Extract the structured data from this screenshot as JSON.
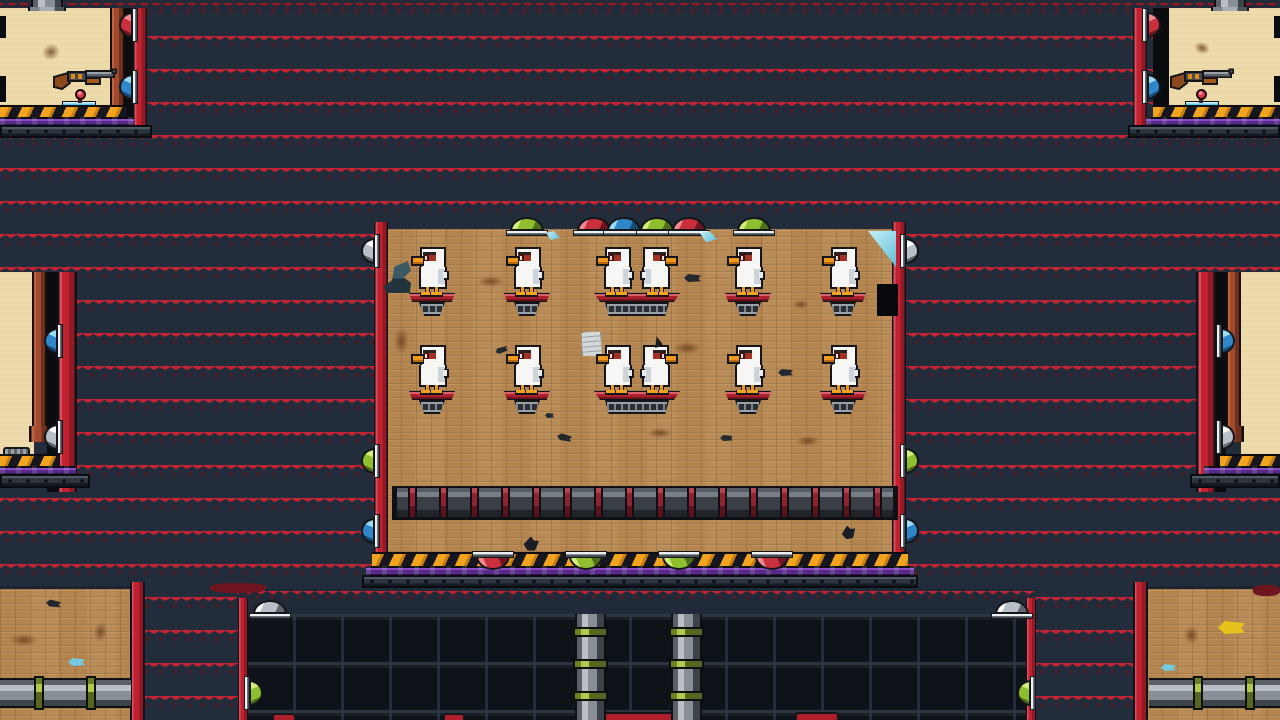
{
  "scene": {
    "description": "pixel-art duck shooting-gallery level",
    "visible_text": [],
    "palette": {
      "wall_red": "#c22433",
      "wall_stripe_dark": "#8e1824",
      "wall_trim_navy": "#222c3a",
      "wood": "#b5854f",
      "beige_room": "#eedbab",
      "hazard_orange": "#f2a41f",
      "goo_purple": "#562a86",
      "grate_dark": "#0e1219",
      "dome_green": "#8fbf2e",
      "dome_red": "#c92f3d",
      "dome_blue": "#2f86c9",
      "dome_silver": "#b9bfc6",
      "duck_white": "#f6f6f4",
      "duck_beak_orange": "#f0991c",
      "perch_red": "#ac1f2c"
    },
    "counts": {
      "ducks": 12,
      "perches": 10,
      "shotguns": 2,
      "spawn_pins": 2
    },
    "regions": [
      {
        "t": "redband",
        "x": 0,
        "y": 0,
        "w": 1280,
        "h": 10
      },
      {
        "t": "beige",
        "x": 0,
        "y": 8,
        "w": 112,
        "h": 99
      },
      {
        "t": "pillar",
        "x": 110,
        "y": 8,
        "w": 15,
        "h": 101
      },
      {
        "t": "gap",
        "x": 125,
        "y": 8,
        "w": 9,
        "h": 122
      },
      {
        "t": "beam",
        "x": 133,
        "y": 8,
        "w": 14,
        "h": 124
      },
      {
        "t": "hazard",
        "x": 0,
        "y": 105,
        "w": 127,
        "h": 14
      },
      {
        "t": "purple",
        "x": 0,
        "y": 117,
        "w": 134,
        "h": 10
      },
      {
        "t": "basebar",
        "x": 0,
        "y": 125,
        "w": 152,
        "h": 13
      },
      {
        "t": "beige",
        "x": 1168,
        "y": 8,
        "w": 112,
        "h": 99
      },
      {
        "t": "gap",
        "x": 1153,
        "y": 8,
        "w": 16,
        "h": 122
      },
      {
        "t": "beam",
        "x": 1133,
        "y": 8,
        "w": 14,
        "h": 124
      },
      {
        "t": "hazard",
        "x": 1153,
        "y": 105,
        "w": 127,
        "h": 14
      },
      {
        "t": "purple",
        "x": 1146,
        "y": 117,
        "w": 134,
        "h": 10
      },
      {
        "t": "basebar",
        "x": 1128,
        "y": 125,
        "w": 152,
        "h": 13
      },
      {
        "t": "beige",
        "x": 0,
        "y": 272,
        "w": 34,
        "h": 184
      },
      {
        "t": "pillar",
        "x": 32,
        "y": 272,
        "w": 15,
        "h": 170,
        "cap": true
      },
      {
        "t": "gap",
        "x": 47,
        "y": 272,
        "w": 10,
        "h": 220
      },
      {
        "t": "beam",
        "x": 57,
        "y": 272,
        "w": 20,
        "h": 220
      },
      {
        "t": "hazard",
        "x": 0,
        "y": 454,
        "w": 60,
        "h": 14
      },
      {
        "t": "purple",
        "x": 0,
        "y": 466,
        "w": 76,
        "h": 10
      },
      {
        "t": "basebar",
        "x": 0,
        "y": 474,
        "w": 90,
        "h": 14
      },
      {
        "t": "beige",
        "x": 1241,
        "y": 272,
        "w": 39,
        "h": 184
      },
      {
        "t": "pillar",
        "x": 1226,
        "y": 272,
        "w": 15,
        "h": 170,
        "cap": true
      },
      {
        "t": "gap",
        "x": 1216,
        "y": 272,
        "w": 10,
        "h": 220
      },
      {
        "t": "beam",
        "x": 1196,
        "y": 272,
        "w": 20,
        "h": 220
      },
      {
        "t": "hazard",
        "x": 1220,
        "y": 454,
        "w": 60,
        "h": 14
      },
      {
        "t": "purple",
        "x": 1204,
        "y": 466,
        "w": 76,
        "h": 10
      },
      {
        "t": "basebar",
        "x": 1190,
        "y": 474,
        "w": 90,
        "h": 14
      },
      {
        "t": "wood",
        "x": 386,
        "y": 229,
        "w": 508,
        "h": 325
      },
      {
        "t": "beam",
        "x": 374,
        "y": 222,
        "w": 14,
        "h": 362
      },
      {
        "t": "beam",
        "x": 892,
        "y": 222,
        "w": 14,
        "h": 362
      },
      {
        "t": "hazard",
        "x": 372,
        "y": 552,
        "w": 536,
        "h": 16
      },
      {
        "t": "purple",
        "x": 366,
        "y": 566,
        "w": 548,
        "h": 11
      },
      {
        "t": "basebar",
        "x": 362,
        "y": 575,
        "w": 556,
        "h": 13
      },
      {
        "t": "wood",
        "x": 0,
        "y": 586,
        "w": 131,
        "h": 134,
        "topline": true
      },
      {
        "t": "wood",
        "x": 1147,
        "y": 586,
        "w": 133,
        "h": 134,
        "topline": true
      },
      {
        "t": "redband",
        "x": 237,
        "y": 588,
        "w": 798,
        "h": 27
      },
      {
        "t": "grid",
        "x": 245,
        "y": 614,
        "w": 781,
        "h": 106
      },
      {
        "t": "beam",
        "x": 238,
        "y": 598,
        "w": 10,
        "h": 122
      },
      {
        "t": "beam",
        "x": 1026,
        "y": 598,
        "w": 10,
        "h": 122
      },
      {
        "t": "beam",
        "x": 130,
        "y": 582,
        "w": 15,
        "h": 138
      },
      {
        "t": "beam",
        "x": 1133,
        "y": 582,
        "w": 15,
        "h": 138
      },
      {
        "t": "tongue",
        "x": 272,
        "y": 713,
        "w": 24,
        "h": 7
      },
      {
        "t": "tongue",
        "x": 443,
        "y": 713,
        "w": 22,
        "h": 7
      },
      {
        "t": "tongue",
        "x": 600,
        "y": 712,
        "w": 78,
        "h": 8
      },
      {
        "t": "tongue",
        "x": 795,
        "y": 712,
        "w": 44,
        "h": 8
      },
      {
        "t": "strip",
        "x": 0,
        "y": 16,
        "w": 6,
        "h": 22
      },
      {
        "t": "strip",
        "x": 0,
        "y": 76,
        "w": 6,
        "h": 26
      },
      {
        "t": "strip",
        "x": 1274,
        "y": 16,
        "w": 6,
        "h": 22
      },
      {
        "t": "strip",
        "x": 1274,
        "y": 76,
        "w": 6,
        "h": 26
      }
    ],
    "pipes": [
      {
        "t": "stub",
        "x": 31,
        "y": 0,
        "w": 32,
        "h": 9,
        "flange": true
      },
      {
        "t": "stub",
        "x": 1214,
        "y": 0,
        "w": 32,
        "h": 9,
        "flange": true
      },
      {
        "t": "bigpipe",
        "x": 392,
        "y": 486,
        "w": 506,
        "h": 34,
        "cstart": 16,
        "cstep": 31
      },
      {
        "t": "vpipe",
        "x": 575,
        "y": 614,
        "w": 31,
        "h": 106,
        "bands": [
          13,
          45,
          77
        ]
      },
      {
        "t": "vpipe",
        "x": 671,
        "y": 614,
        "w": 31,
        "h": 106,
        "bands": [
          13,
          45,
          77
        ]
      },
      {
        "t": "hpipe",
        "x": 0,
        "y": 678,
        "w": 131,
        "h": 30,
        "bands": [
          34,
          86
        ]
      },
      {
        "t": "hpipe",
        "x": 1149,
        "y": 678,
        "w": 131,
        "h": 30,
        "bands": [
          44,
          96
        ]
      }
    ],
    "dome_lights": [
      {
        "dir": "up",
        "color": "green",
        "x": 510,
        "y": 217
      },
      {
        "dir": "up",
        "color": "red",
        "x": 577,
        "y": 217
      },
      {
        "dir": "up",
        "color": "blue",
        "x": 607,
        "y": 217
      },
      {
        "dir": "up",
        "color": "green",
        "x": 640,
        "y": 217
      },
      {
        "dir": "up",
        "color": "red",
        "x": 672,
        "y": 217
      },
      {
        "dir": "up",
        "color": "green",
        "x": 737,
        "y": 217
      },
      {
        "dir": "down",
        "color": "red",
        "x": 476,
        "y": 556
      },
      {
        "dir": "down",
        "color": "green",
        "x": 569,
        "y": 556
      },
      {
        "dir": "down",
        "color": "green",
        "x": 662,
        "y": 556
      },
      {
        "dir": "down",
        "color": "red",
        "x": 755,
        "y": 556
      },
      {
        "dir": "left",
        "color": "red",
        "x": 119,
        "y": 12
      },
      {
        "dir": "left",
        "color": "blue",
        "x": 119,
        "y": 74
      },
      {
        "dir": "right",
        "color": "red",
        "x": 1147,
        "y": 12
      },
      {
        "dir": "right",
        "color": "blue",
        "x": 1147,
        "y": 74
      },
      {
        "dir": "left",
        "color": "blue",
        "x": 44,
        "y": 328
      },
      {
        "dir": "left",
        "color": "silver",
        "x": 44,
        "y": 424
      },
      {
        "dir": "right",
        "color": "blue",
        "x": 1221,
        "y": 328
      },
      {
        "dir": "right",
        "color": "silver",
        "x": 1221,
        "y": 424
      },
      {
        "dir": "left",
        "color": "silver",
        "x": 361,
        "y": 238
      },
      {
        "dir": "left",
        "color": "green",
        "x": 361,
        "y": 448
      },
      {
        "dir": "left",
        "color": "blue",
        "x": 361,
        "y": 518
      },
      {
        "dir": "right",
        "color": "silver",
        "x": 905,
        "y": 238
      },
      {
        "dir": "right",
        "color": "green",
        "x": 905,
        "y": 448
      },
      {
        "dir": "right",
        "color": "blue",
        "x": 905,
        "y": 518
      },
      {
        "dir": "up",
        "color": "silver",
        "x": 253,
        "y": 600
      },
      {
        "dir": "up",
        "color": "silver",
        "x": 995,
        "y": 600
      },
      {
        "dir": "right",
        "color": "green",
        "x": 249,
        "y": 680
      },
      {
        "dir": "left",
        "color": "green",
        "x": 1017,
        "y": 680
      }
    ],
    "perches": [
      {
        "cx": 432,
        "y": 293,
        "double": false
      },
      {
        "cx": 527,
        "y": 293,
        "double": false
      },
      {
        "cx": 637,
        "y": 293,
        "double": true
      },
      {
        "cx": 748,
        "y": 293,
        "double": false
      },
      {
        "cx": 843,
        "y": 293,
        "double": false
      },
      {
        "cx": 432,
        "y": 391,
        "double": false
      },
      {
        "cx": 527,
        "y": 391,
        "double": false
      },
      {
        "cx": 637,
        "y": 391,
        "double": true,
        "plume": true
      },
      {
        "cx": 748,
        "y": 391,
        "double": false
      },
      {
        "cx": 843,
        "y": 391,
        "double": false
      }
    ],
    "guns": [
      {
        "x": 53,
        "y": 66
      },
      {
        "x": 1170,
        "y": 66
      }
    ],
    "pins": [
      {
        "x": 75,
        "y": 89
      },
      {
        "x": 1196,
        "y": 89
      }
    ],
    "platforms": [
      {
        "x": 62,
        "y": 101,
        "w": 34
      },
      {
        "x": 1185,
        "y": 101,
        "w": 34
      }
    ],
    "debris": [
      {
        "k": "stain",
        "x": 42,
        "y": 44,
        "w": 18,
        "h": 16,
        "r": -30
      },
      {
        "k": "stain",
        "x": 1194,
        "y": 42,
        "w": 16,
        "h": 12,
        "r": 20
      },
      {
        "k": "stain",
        "x": 394,
        "y": 328,
        "w": 15,
        "h": 26,
        "r": 0
      },
      {
        "k": "stain",
        "x": 478,
        "y": 276,
        "w": 26,
        "h": 11,
        "r": 0
      },
      {
        "k": "stain",
        "x": 673,
        "y": 342,
        "w": 28,
        "h": 12,
        "r": 0
      },
      {
        "k": "stain",
        "x": 793,
        "y": 300,
        "w": 16,
        "h": 9,
        "r": 0
      },
      {
        "k": "stain",
        "x": 648,
        "y": 428,
        "w": 24,
        "h": 10,
        "r": 0
      },
      {
        "k": "stain",
        "x": 796,
        "y": 436,
        "w": 24,
        "h": 10,
        "r": 0
      },
      {
        "k": "stain",
        "x": 10,
        "y": 634,
        "w": 28,
        "h": 12,
        "r": 0
      },
      {
        "k": "stain",
        "x": 94,
        "y": 622,
        "w": 13,
        "h": 20,
        "r": 10
      },
      {
        "k": "stain",
        "x": 1184,
        "y": 626,
        "w": 15,
        "h": 18,
        "r": -10
      },
      {
        "k": "feather",
        "x": 684,
        "y": 274,
        "w": 17,
        "h": 8,
        "c": "#23282f",
        "r": 0
      },
      {
        "k": "feather",
        "x": 495,
        "y": 347,
        "w": 13,
        "h": 6,
        "c": "#23282f",
        "r": -20
      },
      {
        "k": "feather",
        "x": 545,
        "y": 413,
        "w": 9,
        "h": 5,
        "c": "#23282f",
        "r": 0
      },
      {
        "k": "feather",
        "x": 557,
        "y": 434,
        "w": 15,
        "h": 7,
        "c": "#23282f",
        "r": 12
      },
      {
        "k": "feather",
        "x": 720,
        "y": 435,
        "w": 13,
        "h": 6,
        "c": "#23282f",
        "r": 0
      },
      {
        "k": "feather",
        "x": 778,
        "y": 369,
        "w": 15,
        "h": 7,
        "c": "#23282f",
        "r": 0
      },
      {
        "k": "feather",
        "x": 524,
        "y": 538,
        "w": 14,
        "h": 13,
        "c": "#1a1e24",
        "r": -60
      },
      {
        "k": "feather",
        "x": 842,
        "y": 527,
        "w": 13,
        "h": 12,
        "c": "#1a1e24",
        "r": -70
      },
      {
        "k": "feather",
        "x": 46,
        "y": 600,
        "w": 15,
        "h": 7,
        "c": "#23282f",
        "r": 8
      },
      {
        "k": "feather",
        "x": 68,
        "y": 658,
        "w": 17,
        "h": 8,
        "c": "#76c8dd",
        "r": 0
      },
      {
        "k": "feather",
        "x": 1161,
        "y": 664,
        "w": 15,
        "h": 7,
        "c": "#76c8dd",
        "r": 0
      },
      {
        "k": "feather",
        "x": 1218,
        "y": 621,
        "w": 27,
        "h": 13,
        "c": "#e8c21c",
        "r": 0
      },
      {
        "k": "paper",
        "x": 581,
        "y": 331,
        "w": 21,
        "h": 26
      },
      {
        "k": "hat",
        "x": 384,
        "y": 261,
        "w": 27,
        "h": 32
      },
      {
        "k": "notch",
        "x": 877,
        "y": 284,
        "w": 21,
        "h": 32
      },
      {
        "k": "shard",
        "x": 868,
        "y": 231,
        "w": 28,
        "h": 36,
        "kind": "corner"
      },
      {
        "k": "shard",
        "x": 546,
        "y": 231,
        "w": 14,
        "h": 9,
        "kind": "bit"
      },
      {
        "k": "shard",
        "x": 700,
        "y": 231,
        "w": 17,
        "h": 11,
        "kind": "bit"
      },
      {
        "k": "vent",
        "x": 3,
        "y": 447,
        "w": 27,
        "h": 9
      },
      {
        "k": "blob",
        "x": 210,
        "y": 583,
        "w": 56,
        "h": 10
      },
      {
        "k": "blob",
        "x": 1253,
        "y": 585,
        "w": 27,
        "h": 11
      }
    ]
  }
}
